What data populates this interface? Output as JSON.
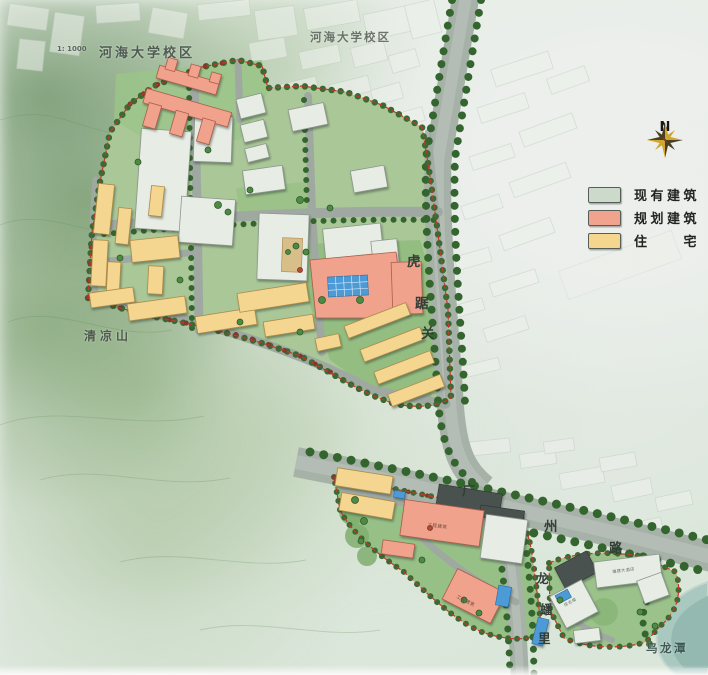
{
  "labels": {
    "scale": "1: 1000",
    "campus_left": "河海大学校区",
    "campus_top": "河海大学校区",
    "mountain": "清凉山",
    "pond": "乌龙潭",
    "hujuguan": [
      "虎",
      "踞",
      "关"
    ],
    "guangzhou": [
      "广",
      "州",
      "路"
    ],
    "longpanli": [
      "龙",
      "蟠",
      "里"
    ],
    "buildings": {
      "engineering_main": "工程建筑",
      "engineering_south": "工程建筑",
      "hotel": "福建大酒店",
      "complex_tower": "综合楼"
    }
  },
  "legend": {
    "items": [
      {
        "label": "现有建筑",
        "color": "#ccdacc"
      },
      {
        "label": "规划建筑",
        "color": "#f2a38e"
      },
      {
        "label": "住　　宅",
        "color": "#f5d68f"
      }
    ]
  },
  "compass": {
    "north_label": "N"
  },
  "colors": {
    "existing_building": "#e7ece5",
    "planned_building": "#f1a28d",
    "residential_building": "#f4d690",
    "road": "#a6b1a8",
    "pool_water": "#4d9bd6",
    "pond_water": "#a9c8c0",
    "boundary_line": "#bf3a28",
    "tree": "#35652f"
  }
}
